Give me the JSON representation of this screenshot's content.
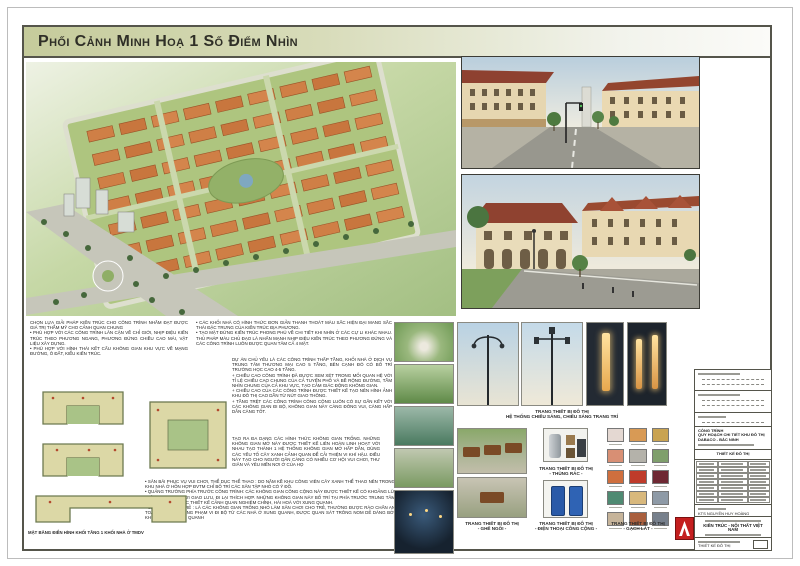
{
  "page": {
    "title": "Phối Cảnh Minh Hoạ 1 Số Điểm Nhìn"
  },
  "colors": {
    "header_green": "#c5cb9b",
    "frame": "#55554b",
    "logo_red": "#c41f1f",
    "roof_orange": "#cf7f46",
    "site_green": "#aec57f"
  },
  "texts": {
    "left_block": "CHỌN LỰA GIẢI PHÁP KIẾN TRÚC CHO CÔNG TRÌNH NHẰM ĐẠT ĐƯỢC GIÁ TRỊ THẨM MỸ CHO CẢNH QUAN CHUNG\n• PHÙ HỢP VỚI CÁC CÔNG TRÌNH LÂN CẬN VỀ CHỈ GIỚI, NHỊP ĐIỆU KIẾN TRÚC THEO PHƯƠNG NGANG, PHƯƠNG ĐỨNG CHIỀU CAO MÁI, VẬT LIỆU XÂY DỰNG.\n• PHÙ HỢP VỚI HÌNH THÁI KẾT CẤU KHÔNG GIAN KHU VỰC VỀ MẠNG ĐƯỜNG, Ô ĐẤT, KIỂU KIẾN TRÚC.",
    "mid_block_1": "• CÁC KHỐI NHÀ CÓ HÌNH THỨC ĐƠN GIẢN THANH THOÁT MÀU SẮC HIỆN ĐẠI MANG SẮC THÁI ĐẶC TRƯNG CỦA KIẾN TRÚC ĐỊA PHƯƠNG.\n• TẠO MẶT ĐỨNG KIẾN TRÚC PHONG PHÚ VỀ CHI TIẾT KHI NHÌN Ở CÁC CỰ LI KHÁC NHAU. THỦ PHÁP MÀU CHỦ ĐẠO LÀ NHẤN MẠNH NHỊP ĐIỆU KIẾN TRÚC THEO PHƯƠNG ĐỨNG VÀ CÁC CÔNG TRÌNH LUÔN ĐƯỢC QUAN TÂM CẢ 4 MẶT.",
    "mid_block_2": "DỰ ÁN CHỦ YẾU LÀ CÁC CÔNG TRÌNH THẤP TẦNG, KHỐI NHÀ Ở DỊCH VỤ TRUNG TÂM THƯƠNG MẠI CAO 5 TẦNG, BÊN CẠNH ĐÓ CÓ BỐ TRÍ TRƯỜNG HỌC CAO 4-5 TẦNG.\n+ CHIỀU CAO CÔNG TRÌNH ĐÃ ĐƯỢC XEM XÉT TRONG MỐI QUAN HỆ VỚI TỈ LỆ CHIỀU CAO CHUNG CỦA CẢ TUYẾN PHỐ VÀ BỀ RỘNG ĐƯỜNG, TẦM NHÌN CHUNG CỦA CẢ KHU VỰC, TẠO CẢM GIÁC ĐỘNG KHÔNG GIAN.\n+ CHIỀU CAO CỦA CÁC CÔNG TRÌNH ĐƯỢC THIẾT KẾ TẠO NÊN HÌNH ẢNH KHU ĐÔ THỊ CAO DẦN TỪ NÚT GIAO THÔNG.\n+ TẦNG TRỆT CÁC CÔNG TRÌNH CÔNG CỘNG LUÔN CÓ SỰ GẮN KẾT VỚI CÁC KHÔNG GIAN ĐI BỘ, KHÔNG GIAN NÀY CÀNG ĐÔNG VUI, CÀNG HẤP DẪN CÀNG TỐT.",
    "mid_block_3": "TẠO RA ĐA DẠNG CÁC HÌNH THỨC KHÔNG GIAN TRỐNG. NHỮNG KHÔNG GIAN MỞ NÀY ĐƯỢC THIẾT KẾ LIÊN HOÀN LINH HOẠT VỚI NHAU TẠO THÀNH 1 HỆ THỐNG KHÔNG GIAN MỞ HẤP DẪN, DÙNG CÁC YẾU TỐ CÂY XANH CẢNH QUAN ĐỂ CẢI THIỆN VI KHÍ HẬU. ĐIỀU NÀY TẠO CHO NGƯỜI DÂN CÀNG CÓ NHIỀU CƠ HỘI VUI CHƠI, THƯ GIÃN VÀ YÊU MẾN NƠI Ở CỦA HỌ",
    "bottom_block": "• SÂN BÃI PHỤC VỤ VUI CHƠI, THỂ DỤC THỂ THAO : DO NẰM KỀ KHU CÔNG VIÊN CÂY XANH THỂ THAO NÊN TRONG KHU NHÀ Ở HỖN HỢP ĐVTM CHỈ BỐ TRÍ CÁC SÂN TẬP NHỎ CÓ Ý ĐỒ.\n• QUẢNG TRƯỜNG PHÍA TRƯỚC CÔNG TRÌNH: CÁC KHÔNG GIAN CÔNG CỘNG NÀY ĐƯỢC THIẾT KẾ CÓ KHOẢNG LÙI THÍCH HỢP TẠO NƠI GIAO LƯU, ĐI LẠI THÍCH HỢP. NHỮNG KHÔNG GIAN NÀY BỐ TRÍ TẠI PHÍA TRƯỚC TRUNG TÂM THƯƠNG MẠI ĐƯỢC THIẾT KẾ CẢNH QUAN NGHIÊM CHỈNH, HÀI HOÀ VỚI XUNG QUANH.\n• SÂN CHƠI CHO TRẺ : LÀ CÁC KHÔNG GIAN TRỐNG NHỎ LÀM SÂN CHƠI CHO TRẺ, THƯỜNG ĐƯỢC RÀO CHẮN AN TOÀN VÀ NẰM TRONG PHẠM VI ĐI BỘ TỪ CÁC NHÀ Ở XUNG QUANH, ĐƯỢC QUAN SÁT TRÔNG NOM DỄ DÀNG BỞI KHU DÂN CƯ XUNG QUANH"
  },
  "captions": {
    "plan_caption": "MẶT BẰNG ĐIỂN HÌNH KHỐI TẦNG 1 KHỐI NHÀ Ở TMDV",
    "equip_line1": "TRANG THIẾT BỊ ĐÔ THỊ",
    "equip_line2": "HỆ THỐNG CHIẾU SÁNG, CHIẾU SÁNG TRANG TRÍ",
    "bench_line1": "TRANG THIẾT BỊ ĐÔ THỊ",
    "bench_line2": "- GHẾ NGỒI -",
    "bins_line1": "TRANG THIẾT BỊ ĐÔ THỊ",
    "bins_line2": "- THÙNG RÁC -",
    "phone_line1": "TRANG THIẾT BỊ ĐÔ THỊ",
    "phone_line2": "- ĐIỆN THOẠI CÔNG CỘNG -",
    "tiles_line1": "TRANG THIẾT BỊ ĐÔ THỊ",
    "tiles_line2": "- GẠCH LÁT -"
  },
  "tiles": {
    "colors": [
      "#e4d8d2",
      "#d89a55",
      "#c9a351",
      "#d88f74",
      "#b4b2aa",
      "#7f9f6c",
      "#cf6f3e",
      "#bf3b2a",
      "#6e2833",
      "#4f8a72",
      "#d8b87c",
      "#8e9aa6",
      "#c6b49a",
      "#a95f3e",
      "#77808c"
    ]
  },
  "titleblock": {
    "project_label": "CÔNG TRÌNH",
    "project_name": "QUY HOẠCH CHI TIẾT KHU ĐÔ THỊ DABACO - BẮC NINH",
    "design_label": "THIẾT KẾ ĐÔ THỊ",
    "chief_architect": "KTS NGUYỄN HUY HOÀNG",
    "company_name": "KIẾN TRÚC - NỘI THẤT VIỆT NAM",
    "sheet_label": "THIẾT KẾ ĐÔ THỊ"
  }
}
